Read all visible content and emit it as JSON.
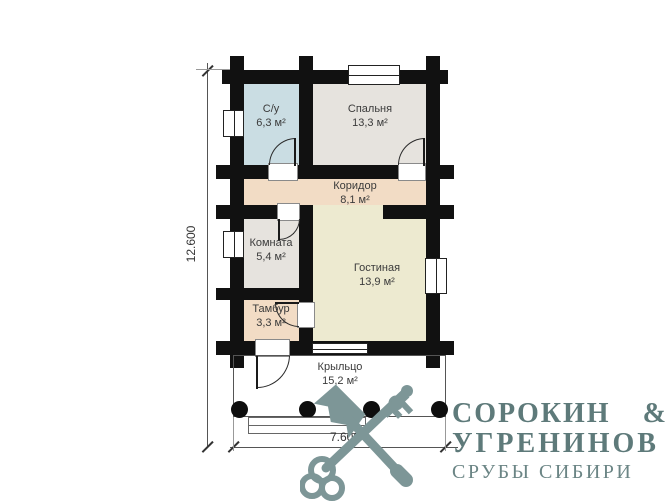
{
  "plan": {
    "rooms": [
      {
        "name": "С/у",
        "area": "6,3 м²"
      },
      {
        "name": "Спальня",
        "area": "13,3 м²"
      },
      {
        "name": "Коридор",
        "area": "8,1 м²"
      },
      {
        "name": "Комната",
        "area": "5,4 м²"
      },
      {
        "name": "Гостиная",
        "area": "13,9 м²"
      },
      {
        "name": "Тамбур",
        "area": "3,3 м²"
      },
      {
        "name": "Крыльцо",
        "area": "15,2 м²"
      }
    ],
    "dimensions": {
      "vertical": "12.600",
      "horizontal": "7.600"
    },
    "colors": {
      "wall": "#111111",
      "room_su": "#cadde3",
      "room_spalnya": "#e6e3de",
      "room_koridor": "#f2dcc5",
      "room_komnata": "#e6e3de",
      "room_gostinaya": "#edead0",
      "room_tambur": "#f2dcc5",
      "porch": "#ffffff"
    }
  },
  "logo": {
    "icon": "crossed-axe-and-key-icon",
    "name_part1": "СОРОКИН",
    "ampersand": "&",
    "name_part2": "УГРЕНИНОВ",
    "tagline": "СРУБЫ СИБИРИ",
    "color_text": "#5e7a7a",
    "color_icon": "#7d9697"
  }
}
